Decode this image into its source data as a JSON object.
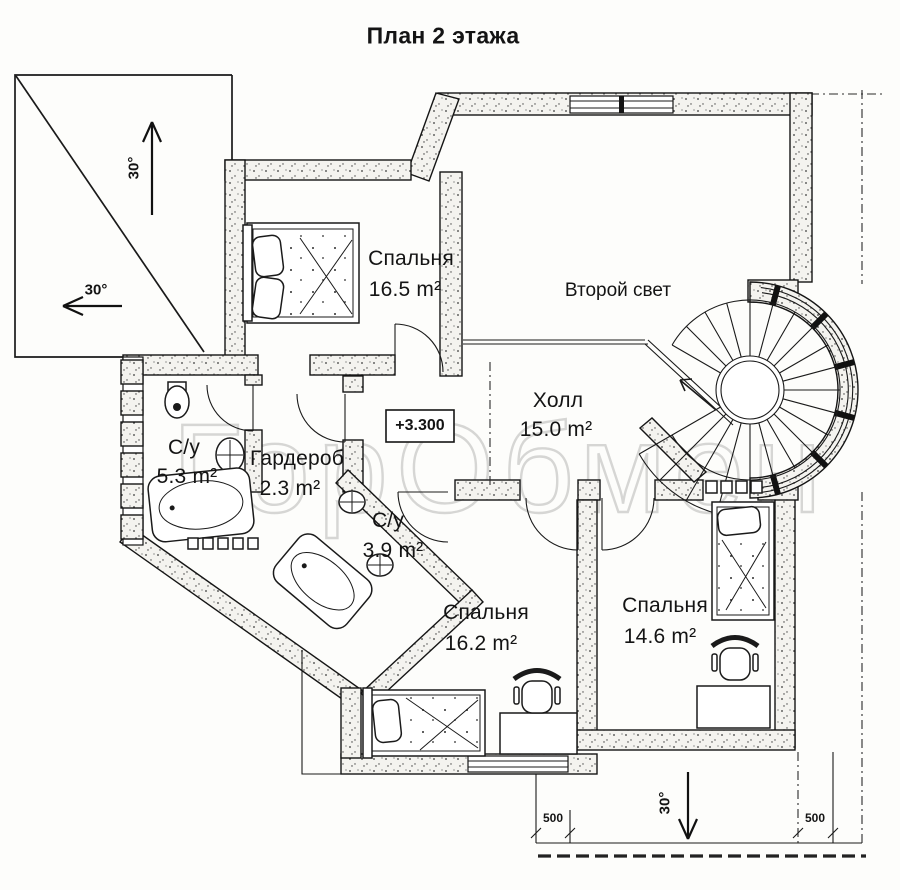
{
  "title": "План 2 этажа",
  "watermark": "ГорОбмен",
  "rooms": [
    {
      "name": "Спальня",
      "area": "16.5 m²"
    },
    {
      "name": "Второй свет",
      "area": ""
    },
    {
      "name": "Холл",
      "area": "15.0 m²"
    },
    {
      "name": "С/у",
      "area": "5.3 m²"
    },
    {
      "name": "Гардероб",
      "area": "2.3 m²"
    },
    {
      "name": "С/у",
      "area": "3.9 m²"
    },
    {
      "name": "Спальня",
      "area": "16.2 m²"
    },
    {
      "name": "Спальня",
      "area": "14.6 m²"
    }
  ],
  "annotations": {
    "elevation": "+3.300",
    "roof_slope_top": "30°",
    "roof_slope_left": "30°",
    "roof_slope_bottom": "30°",
    "dim_left": "500",
    "dim_right": "500"
  }
}
